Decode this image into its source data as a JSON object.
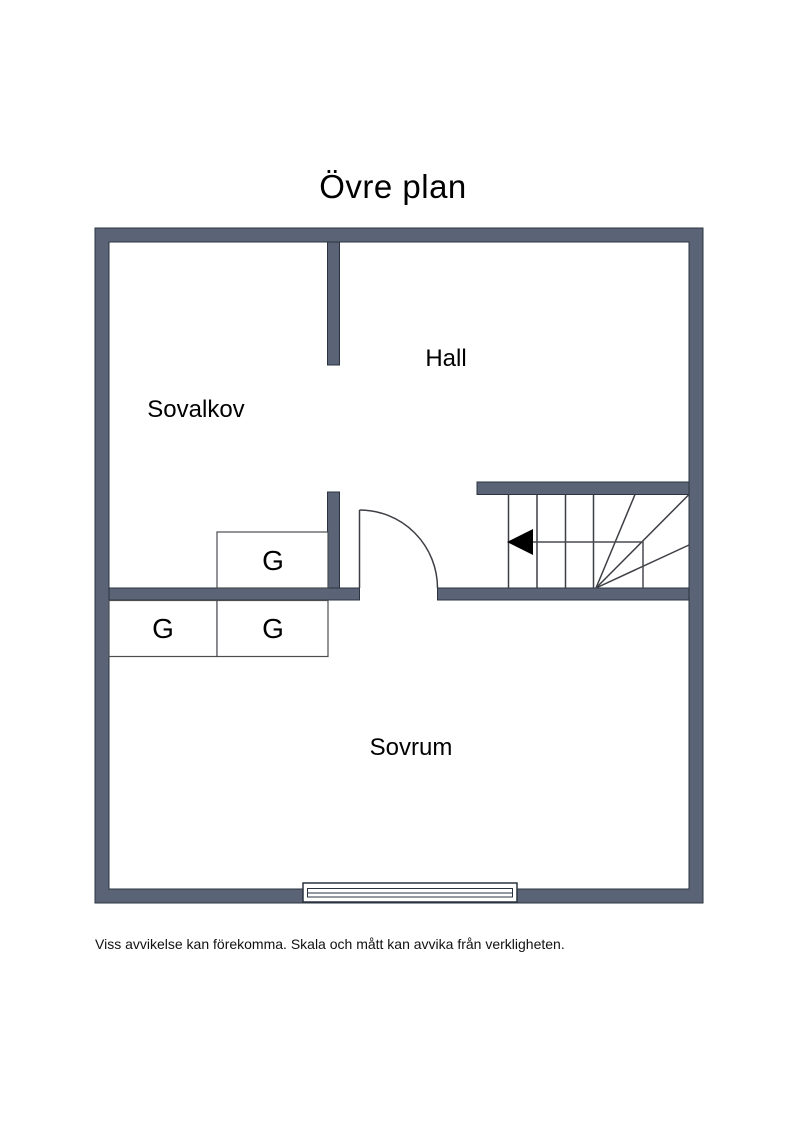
{
  "title": "Övre plan",
  "plan": {
    "rooms": [
      {
        "name": "sovalkov",
        "label": "Sovalkov"
      },
      {
        "name": "hall",
        "label": "Hall"
      },
      {
        "name": "sovrum",
        "label": "Sovrum"
      }
    ],
    "closets": [
      {
        "label": "G"
      },
      {
        "label": "G"
      },
      {
        "label": "G"
      }
    ],
    "icons": {
      "stairs_arrow": "left-pointing solid triangle"
    }
  },
  "colors": {
    "wall_fill": "#5a6476",
    "wall_outline": "#2b3340",
    "detail_line": "#3d3f44"
  },
  "footer": {
    "disclaimer": "Viss avvikelse kan förekomma. Skala och mått kan avvika från verkligheten."
  }
}
